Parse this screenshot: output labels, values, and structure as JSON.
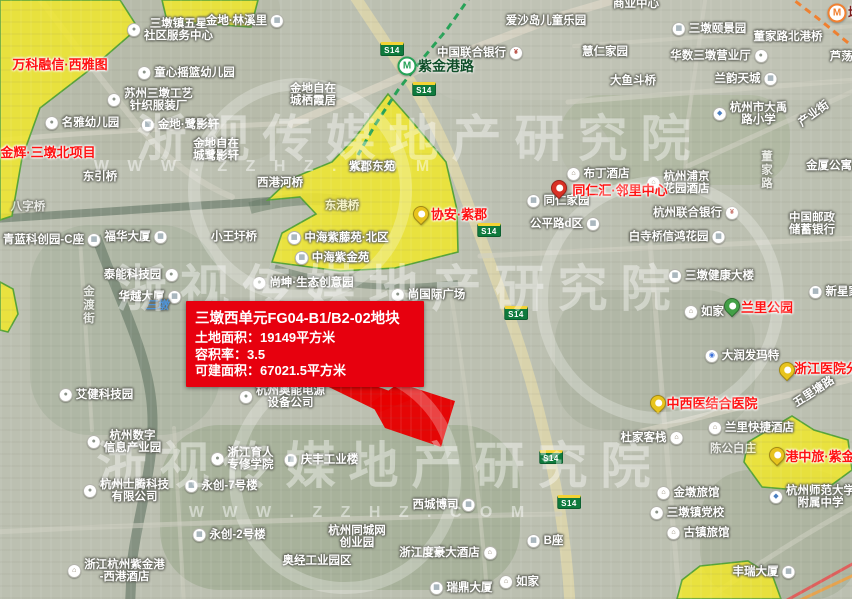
{
  "info_box": {
    "title": "三墩西单元FG04-B1/B2-02地块",
    "area_line": "土地面积：19149平方米",
    "far_line": "容积率：3.5",
    "build_line": "可建面积：67021.5平方米"
  },
  "watermark": {
    "brand": "浙视传媒地产研究院",
    "url_text": "W W W . Z Z H Z . C O M"
  },
  "colors": {
    "parcel_yellow": "rgba(241,232,44,0.85)",
    "parcel_border": "#57a339",
    "red_parcel": "#e60000",
    "metro_green": "#27a257",
    "metro_orange": "#f08030",
    "station_green_text": "#114f2a",
    "station_orange_text": "#7a1c1c"
  },
  "map": {
    "shield_text": "S14",
    "shields": [
      {
        "x": 392,
        "y": 49
      },
      {
        "x": 424,
        "y": 89
      },
      {
        "x": 489,
        "y": 230
      },
      {
        "x": 516,
        "y": 313
      },
      {
        "x": 551,
        "y": 457
      },
      {
        "x": 569,
        "y": 502
      }
    ],
    "stations": [
      {
        "name": "紫金港路",
        "x": 407,
        "y": 66,
        "tx": 418,
        "line": "green"
      },
      {
        "name": "墩祥街",
        "x": 837,
        "y": 13,
        "tx": 848,
        "line": "orange"
      }
    ],
    "pins": [
      {
        "x": 559,
        "y": 196,
        "c": "red"
      },
      {
        "x": 421,
        "y": 222,
        "c": "yellow"
      },
      {
        "x": 732,
        "y": 314,
        "c": "green"
      },
      {
        "x": 787,
        "y": 378,
        "c": "yellow"
      },
      {
        "x": 658,
        "y": 411,
        "c": "yellow"
      },
      {
        "x": 777,
        "y": 463,
        "c": "yellow"
      }
    ],
    "labels": [
      {
        "ls": [
          "三墩镇五星",
          "社区服务中心"
        ],
        "x": 170,
        "y": 30,
        "i": "dot",
        "s": "l"
      },
      {
        "t": "金地·林溪里",
        "x": 245,
        "y": 21,
        "i": "bld",
        "s": "r"
      },
      {
        "t": "童心摇篮幼儿园",
        "x": 186,
        "y": 73,
        "i": "dot",
        "s": "l"
      },
      {
        "ls": [
          "苏州三墩工艺",
          "针织服装厂"
        ],
        "x": 150,
        "y": 100,
        "i": "dot",
        "s": "l"
      },
      {
        "ls": [
          "金地自在",
          "城栖霞居"
        ],
        "x": 313,
        "y": 95
      },
      {
        "t": "中国联合银行",
        "x": 480,
        "y": 53,
        "i": "bank",
        "s": "r"
      },
      {
        "t": "爱沙岛儿童乐园",
        "x": 546,
        "y": 21
      },
      {
        "t": "商业中心",
        "x": 636,
        "y": 4
      },
      {
        "t": "三墩颐景园",
        "x": 709,
        "y": 29,
        "i": "bld",
        "s": "l"
      },
      {
        "t": "董家路北港桥",
        "x": 788,
        "y": 37
      },
      {
        "t": "慧仁家园",
        "x": 605,
        "y": 52
      },
      {
        "t": "华数三墩营业厅",
        "x": 719,
        "y": 56,
        "i": "dot",
        "s": "r"
      },
      {
        "t": "兰韵天城",
        "x": 746,
        "y": 79,
        "i": "bld",
        "s": "r"
      },
      {
        "t": "大鱼斗桥",
        "x": 633,
        "y": 81
      },
      {
        "t": "芦荡湾",
        "x": 847,
        "y": 57
      },
      {
        "ls": [
          "杭州市大禹",
          "路小学"
        ],
        "x": 750,
        "y": 114,
        "i": "school",
        "s": "l"
      },
      {
        "t": "产业街",
        "x": 814,
        "y": 114,
        "rot": -36
      },
      {
        "t": "金厦公寓",
        "x": 829,
        "y": 166
      },
      {
        "ls": [
          "中国邮政",
          "储蓄银行"
        ],
        "x": 812,
        "y": 224
      },
      {
        "t": "杭州联合银行",
        "x": 696,
        "y": 213,
        "i": "bank",
        "s": "r"
      },
      {
        "t": "布丁酒店",
        "x": 598,
        "y": 174,
        "i": "hotel",
        "s": "l"
      },
      {
        "ls": [
          "杭州浦京",
          "花园酒店"
        ],
        "x": 678,
        "y": 183,
        "i": "hotel",
        "s": "l"
      },
      {
        "t": "同仁家园",
        "x": 558,
        "y": 201,
        "i": "bld",
        "s": "l"
      },
      {
        "t": "公平路d区",
        "x": 565,
        "y": 224,
        "i": "bld",
        "s": "r"
      },
      {
        "t": "白寺桥",
        "x": 646,
        "y": 237
      },
      {
        "t": "信鸿花园",
        "x": 694,
        "y": 237,
        "i": "bld",
        "s": "r"
      },
      {
        "t": "东引桥",
        "x": 100,
        "y": 177
      },
      {
        "t": "西港河桥",
        "x": 280,
        "y": 183
      },
      {
        "t": "金地·鹭影轩",
        "x": 180,
        "y": 125,
        "i": "bld",
        "s": "l"
      },
      {
        "ls": [
          "金地自在",
          "城鹭影轩"
        ],
        "x": 216,
        "y": 150
      },
      {
        "t": "名雅幼儿园",
        "x": 82,
        "y": 123,
        "i": "dot",
        "s": "l"
      },
      {
        "t": "小王圩桥",
        "x": 234,
        "y": 237
      },
      {
        "t": "中海紫藤苑·北区",
        "x": 338,
        "y": 238,
        "i": "bld",
        "s": "l"
      },
      {
        "t": "中海紫金苑",
        "x": 332,
        "y": 258,
        "i": "bld",
        "s": "l"
      },
      {
        "t": "福华大厦",
        "x": 136,
        "y": 237,
        "i": "bld",
        "s": "r"
      },
      {
        "t": "青蓝科创园-C座",
        "x": 52,
        "y": 240,
        "i": "bld",
        "s": "r"
      },
      {
        "t": "泰能科技园",
        "x": 141,
        "y": 275,
        "i": "dot",
        "s": "r"
      },
      {
        "t": "华越大厦",
        "x": 150,
        "y": 297,
        "i": "bld",
        "s": "r"
      },
      {
        "t": "尚坤·生态创意园",
        "x": 303,
        "y": 283,
        "i": "dot",
        "s": "l"
      },
      {
        "t": "尚国际广场",
        "x": 428,
        "y": 295,
        "i": "dot",
        "s": "l"
      },
      {
        "t": "八字桥",
        "x": 28,
        "y": 207,
        "c": "f"
      },
      {
        "t": "紫郡东苑",
        "x": 372,
        "y": 167
      },
      {
        "t": "东港桥",
        "x": 342,
        "y": 206,
        "c": "f"
      },
      {
        "ls": [
          "杭州奥能电源",
          "设备公司"
        ],
        "x": 282,
        "y": 397,
        "i": "dot",
        "s": "l"
      },
      {
        "t": "艾健科技园",
        "x": 96,
        "y": 395,
        "i": "dot",
        "s": "l"
      },
      {
        "ls": [
          "浙江育人",
          "专修学院"
        ],
        "x": 242,
        "y": 459,
        "i": "dot",
        "s": "l"
      },
      {
        "t": "庆丰工业楼",
        "x": 321,
        "y": 460,
        "i": "bld",
        "s": "l"
      },
      {
        "t": "永创-7号楼",
        "x": 221,
        "y": 486,
        "i": "bld",
        "s": "l"
      },
      {
        "t": "永创-2号楼",
        "x": 229,
        "y": 535,
        "i": "bld",
        "s": "l"
      },
      {
        "ls": [
          "杭州数字",
          "信息产业园"
        ],
        "x": 124,
        "y": 442,
        "i": "dot",
        "s": "l"
      },
      {
        "ls": [
          "杭州士腾科技",
          "有限公司"
        ],
        "x": 126,
        "y": 491,
        "i": "dot",
        "s": "l"
      },
      {
        "ls": [
          "浙江杭州紫金港",
          "-西港酒店"
        ],
        "x": 116,
        "y": 571,
        "i": "hotel",
        "s": "l"
      },
      {
        "ls": [
          "杭州同城网",
          "创业园"
        ],
        "x": 357,
        "y": 537
      },
      {
        "t": "奥经工业园区",
        "x": 317,
        "y": 561
      },
      {
        "t": "西城博司",
        "x": 444,
        "y": 505,
        "i": "bld",
        "s": "r"
      },
      {
        "t": "浙江度豪大酒店",
        "x": 448,
        "y": 553,
        "i": "hotel",
        "s": "r"
      },
      {
        "t": "瑞鼎大厦",
        "x": 461,
        "y": 588,
        "i": "bld",
        "s": "l"
      },
      {
        "t": "如家",
        "x": 519,
        "y": 582,
        "i": "hotel",
        "s": "l"
      },
      {
        "t": "B座",
        "x": 545,
        "y": 541,
        "i": "bld",
        "s": "l"
      },
      {
        "t": "三墩健康大楼",
        "x": 711,
        "y": 276,
        "i": "bld",
        "s": "l"
      },
      {
        "t": "如家",
        "x": 704,
        "y": 312,
        "i": "hotel",
        "s": "l"
      },
      {
        "t": "大润发玛特",
        "x": 742,
        "y": 356,
        "i": "shop",
        "s": "l"
      },
      {
        "t": "新星家园",
        "x": 840,
        "y": 292,
        "i": "bld",
        "s": "l"
      },
      {
        "t": "五里塘路",
        "x": 814,
        "y": 392,
        "rot": -33
      },
      {
        "t": "杜家客栈",
        "x": 652,
        "y": 438,
        "i": "hotel",
        "s": "r"
      },
      {
        "t": "兰里快捷酒店",
        "x": 751,
        "y": 428,
        "i": "hotel",
        "s": "l"
      },
      {
        "t": "陈公白庄",
        "x": 733,
        "y": 449,
        "c": "f"
      },
      {
        "t": "金墩旅馆",
        "x": 688,
        "y": 493,
        "i": "hotel",
        "s": "l"
      },
      {
        "t": "三墩镇党校",
        "x": 687,
        "y": 513,
        "i": "dot",
        "s": "l"
      },
      {
        "t": "古镇旅馆",
        "x": 698,
        "y": 533,
        "i": "hotel",
        "s": "l"
      },
      {
        "ls": [
          "杭州师范大学",
          "附属中学"
        ],
        "x": 812,
        "y": 497,
        "i": "school",
        "s": "l"
      },
      {
        "t": "丰瑞大厦",
        "x": 764,
        "y": 572,
        "i": "bld",
        "s": "r"
      },
      {
        "t": "三墩",
        "x": 157,
        "y": 306,
        "c": "b"
      },
      {
        "t": "金渡街",
        "x": 88,
        "y": 305,
        "v": 1,
        "c": "f"
      },
      {
        "t": "董家路",
        "x": 766,
        "y": 170,
        "v": 1,
        "c": "f"
      },
      {
        "t": "万科融信·西雅图",
        "x": 60,
        "y": 65,
        "c": "r"
      },
      {
        "t": "金辉·三墩北项目",
        "x": 48,
        "y": 153,
        "c": "r"
      },
      {
        "t": "同仁汇·邻里中心",
        "x": 620,
        "y": 191,
        "c": "r"
      },
      {
        "t": "协安·紫郡",
        "x": 459,
        "y": 215,
        "c": "r"
      },
      {
        "t": "兰里公园",
        "x": 767,
        "y": 308,
        "c": "r"
      },
      {
        "t": "浙江医院分院",
        "x": 833,
        "y": 369,
        "c": "r"
      },
      {
        "t": "中西医结合医院",
        "x": 712,
        "y": 404,
        "c": "r"
      },
      {
        "t": "港中旅·紫金",
        "x": 820,
        "y": 457,
        "c": "r"
      }
    ],
    "patches": [
      {
        "x": -20,
        "y": -20,
        "w": 300,
        "h": 180,
        "c": "#b2b6a4",
        "o": 0.5,
        "r": 30
      },
      {
        "x": 430,
        "y": -20,
        "w": 430,
        "h": 120,
        "c": "#c3c5ba",
        "o": 0.5,
        "r": 30
      },
      {
        "x": 560,
        "y": 95,
        "w": 230,
        "h": 90,
        "c": "#a7b298",
        "o": 0.55,
        "r": 40
      },
      {
        "x": 480,
        "y": 120,
        "w": 130,
        "h": 130,
        "c": "#bcc0b2",
        "o": 0.6,
        "r": 30
      },
      {
        "x": 30,
        "y": 225,
        "w": 190,
        "h": 210,
        "c": "#a2ae99",
        "o": 0.5,
        "r": 60
      },
      {
        "x": 555,
        "y": 290,
        "w": 200,
        "h": 140,
        "c": "#a5ae98",
        "o": 0.45,
        "r": 50
      },
      {
        "x": 160,
        "y": 425,
        "w": 360,
        "h": 165,
        "c": "#93a385",
        "o": 0.5,
        "r": 60
      },
      {
        "x": 700,
        "y": 470,
        "w": 160,
        "h": 130,
        "c": "#a0aa92",
        "o": 0.5,
        "r": 50
      }
    ],
    "roads": [
      {
        "d": "M352,-8 C398,62 428,104 450,158 C472,212 488,258 508,312 C530,372 546,432 558,498 C564,534 568,568 570,604",
        "w": 11,
        "c": "#dcd5ac",
        "o": 0.9
      },
      {
        "d": "M292,124 L420,69 L560,16 L648,-10",
        "w": 8,
        "c": "#d8d4c4",
        "o": 0.85
      },
      {
        "d": "M-6,141 C70,133 150,129 230,126 L295,123",
        "w": 5,
        "c": "#d2d0c2",
        "o": 0.7
      },
      {
        "d": "M36,-6 C70,38 100,78 132,118 C162,156 196,182 232,197",
        "w": 6,
        "c": "#cfcfc2",
        "o": 0.65
      },
      {
        "d": "M574,46 L856,26",
        "w": 4,
        "c": "#cfcfc2",
        "o": 0.6
      },
      {
        "d": "M568,102 L856,80",
        "w": 5,
        "c": "#cfcfc2",
        "o": 0.65
      },
      {
        "d": "M706,-6 L688,120 L683,210",
        "w": 4,
        "c": "#cfcfc2",
        "o": 0.55
      },
      {
        "d": "M480,256 C600,250 720,244 856,238",
        "w": 5,
        "c": "#cfcfc2",
        "o": 0.65
      },
      {
        "d": "M650,242 C658,340 666,450 680,604",
        "w": 5,
        "c": "#cfcfc2",
        "o": 0.6
      },
      {
        "d": "M632,434 L856,378",
        "w": 6,
        "c": "#d5d3c5",
        "o": 0.7
      },
      {
        "d": "M-6,532 C150,524 350,518 560,514",
        "w": 5,
        "c": "#cfcfc2",
        "o": 0.6
      },
      {
        "d": "M174,428 L184,604",
        "w": 4,
        "c": "#cfcfc2",
        "o": 0.5
      },
      {
        "d": "M452,300 C468,400 480,500 488,604",
        "w": 4,
        "c": "#cfcfc2",
        "o": 0.5
      },
      {
        "d": "M688,166 L856,90",
        "w": 5,
        "c": "#cfcfc2",
        "o": 0.6
      },
      {
        "d": "M700,604 C760,562 808,532 856,506",
        "w": 5,
        "c": "#cfcfc2",
        "o": 0.55
      },
      {
        "d": "M80,238 L92,430",
        "w": 4,
        "c": "#cfcfc2",
        "o": 0.5
      }
    ],
    "waters": [
      {
        "d": "M-6,219 C80,213 180,207 270,201",
        "w": 8,
        "c": "#6d7f6d",
        "o": 0.7
      },
      {
        "d": "M96,236 C118,298 148,352 152,408 C156,462 138,512 132,562 L130,606",
        "w": 10,
        "c": "#6d7f6d",
        "o": 0.7
      },
      {
        "d": "M270,266 C330,287 398,291 458,283",
        "w": 6,
        "c": "#6f816e",
        "o": 0.6
      },
      {
        "d": "M250,208 C280,200 310,196 345,202",
        "w": 12,
        "c": "#657a66",
        "o": 0.5
      }
    ],
    "metro_lines": [
      {
        "d": "M472,-6 L448,28 L420,62 L398,90 L375,125 L358,155",
        "c": "#27a257",
        "w": 3
      },
      {
        "d": "M786,-6 L820,20 L852,46",
        "c": "#f08030",
        "w": 3
      }
    ],
    "accent_lines": [
      {
        "d": "M780,604 L856,562",
        "c": "#e85050",
        "w": 3,
        "o": 0.85
      },
      {
        "d": "M792,604 L856,574",
        "c": "#f0a040",
        "w": 3,
        "o": 0.85
      }
    ],
    "parcels": [
      {
        "pts": [
          [
            0,
            0
          ],
          [
            120,
            0
          ],
          [
            138,
            28
          ],
          [
            92,
            68
          ],
          [
            40,
            108
          ],
          [
            22,
            158
          ],
          [
            12,
            216
          ],
          [
            0,
            220
          ]
        ]
      },
      {
        "pts": [
          [
            162,
            0
          ],
          [
            258,
            0
          ],
          [
            251,
            27
          ],
          [
            167,
            21
          ]
        ]
      },
      {
        "pts": [
          [
            388,
            94
          ],
          [
            410,
            119
          ],
          [
            446,
            162
          ],
          [
            457,
            210
          ],
          [
            458,
            252
          ],
          [
            395,
            268
          ],
          [
            340,
            271
          ],
          [
            272,
            262
          ],
          [
            282,
            233
          ],
          [
            316,
            214
          ],
          [
            300,
            197
          ],
          [
            268,
            200
          ],
          [
            290,
            179
          ],
          [
            332,
            162
          ],
          [
            354,
            139
          ]
        ]
      },
      {
        "pts": [
          [
            792,
            416
          ],
          [
            814,
            430
          ],
          [
            848,
            440
          ],
          [
            852,
            470
          ],
          [
            822,
            492
          ],
          [
            762,
            487
          ],
          [
            744,
            462
          ],
          [
            748,
            442
          ]
        ]
      },
      {
        "pts": [
          [
            700,
            566
          ],
          [
            748,
            561
          ],
          [
            773,
            577
          ],
          [
            781,
            599
          ],
          [
            677,
            599
          ],
          [
            682,
            580
          ]
        ]
      },
      {
        "pts": [
          [
            0,
            282
          ],
          [
            13,
            289
          ],
          [
            18,
            314
          ],
          [
            8,
            332
          ],
          [
            0,
            330
          ]
        ]
      }
    ],
    "red_shapes": [
      {
        "pts": [
          [
            399,
            383
          ],
          [
            455,
            401
          ],
          [
            441,
            447
          ],
          [
            385,
            428
          ],
          [
            371,
            403
          ]
        ]
      },
      {
        "pts": [
          [
            300,
            373
          ],
          [
            342,
            374
          ],
          [
            412,
            399
          ],
          [
            380,
            412
          ]
        ]
      }
    ],
    "wm_circles": [
      {
        "cx": 300,
        "cy": 190,
        "r": 106
      },
      {
        "cx": 345,
        "cy": 478,
        "r": 110
      },
      {
        "cx": 660,
        "cy": 300,
        "r": 118
      }
    ],
    "wm_rows": [
      {
        "kind": "big",
        "x": 420,
        "y": 135
      },
      {
        "kind": "url",
        "x": 265,
        "y": 167
      },
      {
        "kind": "big",
        "x": 400,
        "y": 285
      },
      {
        "kind": "big",
        "x": 380,
        "y": 462
      },
      {
        "kind": "url",
        "x": 360,
        "y": 513
      }
    ]
  }
}
